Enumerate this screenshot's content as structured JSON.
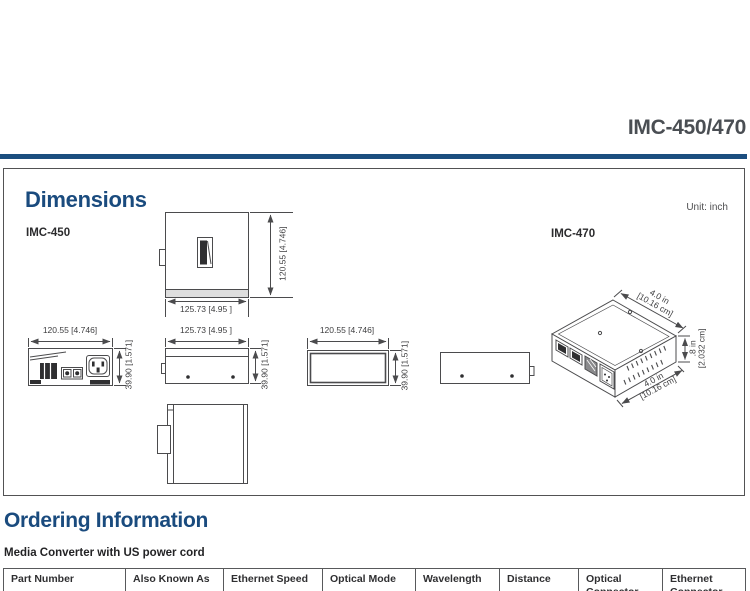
{
  "header": {
    "title": "IMC-450/470"
  },
  "dimensions": {
    "title": "Dimensions",
    "unit": "Unit: inch",
    "model_left": "IMC-450",
    "model_right": "IMC-470",
    "labels": {
      "width": "120.55 [4.746]",
      "length": "125.73 [4.95 ]",
      "height": "39.90 [1.571]",
      "iso_width_in": "4.0 in",
      "iso_width_cm": "[10.16 cm]",
      "iso_height_in": ".8 in",
      "iso_height_cm": "[2.032 cm]"
    }
  },
  "ordering": {
    "title": "Ordering Information",
    "subtitle": "Media Converter with US power cord",
    "table": {
      "headers": [
        "Part Number",
        "Also Known As",
        "Ethernet Speed",
        "Optical Mode",
        "Wavelength",
        "Distance",
        "Optical Connector",
        "Ethernet Connector"
      ]
    }
  },
  "colors": {
    "accent_blue": "#1b4e7f",
    "title_gray": "#4a4e53",
    "line_gray": "#4b4b4d",
    "border_gray": "#58595b"
  }
}
